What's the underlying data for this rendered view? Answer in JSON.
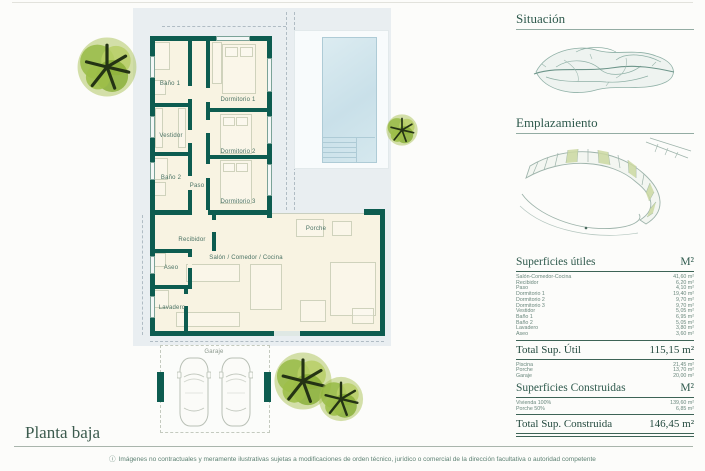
{
  "page": {
    "title": "Planta baja",
    "footer_icon": "ⓘ",
    "footer_note": "Imágenes no contractuales y meramente ilustrativas sujetas a modificaciones de orden técnico, jurídico o comercial de la dirección facultativa o autoridad competente"
  },
  "colors": {
    "wall_teal": "#0d5c50",
    "accent_green": "#2f5a4d",
    "pool_blue": "#c9e0e9",
    "tree_green": "#94b83f",
    "plot_gray": "#e9eef1"
  },
  "sidebar": {
    "situacion_title": "Situación",
    "emplazamiento_title": "Emplazamiento"
  },
  "plan": {
    "rooms": [
      {
        "label": "Baño 1"
      },
      {
        "label": "Dormitorio 1"
      },
      {
        "label": "Vestidor"
      },
      {
        "label": "Dormitorio 2"
      },
      {
        "label": "Baño 2"
      },
      {
        "label": "Paso"
      },
      {
        "label": "Dormitorio 3"
      },
      {
        "label": "Recibidor"
      },
      {
        "label": "Porche"
      },
      {
        "label": "Aseo"
      },
      {
        "label": "Salón / Comedor / Cocina"
      },
      {
        "label": "Lavadero"
      },
      {
        "label": "Garaje"
      }
    ]
  },
  "tables": {
    "utiles": {
      "title": "Superficies útiles",
      "unit": "M²",
      "rows": [
        {
          "label": "Salón-Comedor-Cocina",
          "value": "41,60 m²"
        },
        {
          "label": "Recibidor",
          "value": "6,20 m²"
        },
        {
          "label": "Paso",
          "value": "4,10 m²"
        },
        {
          "label": "Dormitorio 1",
          "value": "19,40 m²"
        },
        {
          "label": "Dormitorio 2",
          "value": "9,70 m²"
        },
        {
          "label": "Dormitorio 3",
          "value": "9,70 m²"
        },
        {
          "label": "Vestidor",
          "value": "5,05 m²"
        },
        {
          "label": "Baño 1",
          "value": "6,95 m²"
        },
        {
          "label": "Baño 2",
          "value": "5,05 m²"
        },
        {
          "label": "Lavadero",
          "value": "3,80 m²"
        },
        {
          "label": "Aseo",
          "value": "3,60 m²"
        }
      ],
      "total_label": "Total Sup. Útil",
      "total_value": "115,15 m²",
      "extra_rows": [
        {
          "label": "Piscina",
          "value": "21,45 m²"
        },
        {
          "label": "Porche",
          "value": "13,70 m²"
        },
        {
          "label": "Garaje",
          "value": "20,00 m²"
        }
      ]
    },
    "construidas": {
      "title": "Superficies Construidas",
      "unit": "M²",
      "rows": [
        {
          "label": "Vivienda 100%",
          "value": "139,60 m²"
        },
        {
          "label": "Porche 50%",
          "value": "6,85 m²"
        }
      ],
      "total_label": "Total Sup. Construida",
      "total_value": "146,45 m²"
    }
  }
}
